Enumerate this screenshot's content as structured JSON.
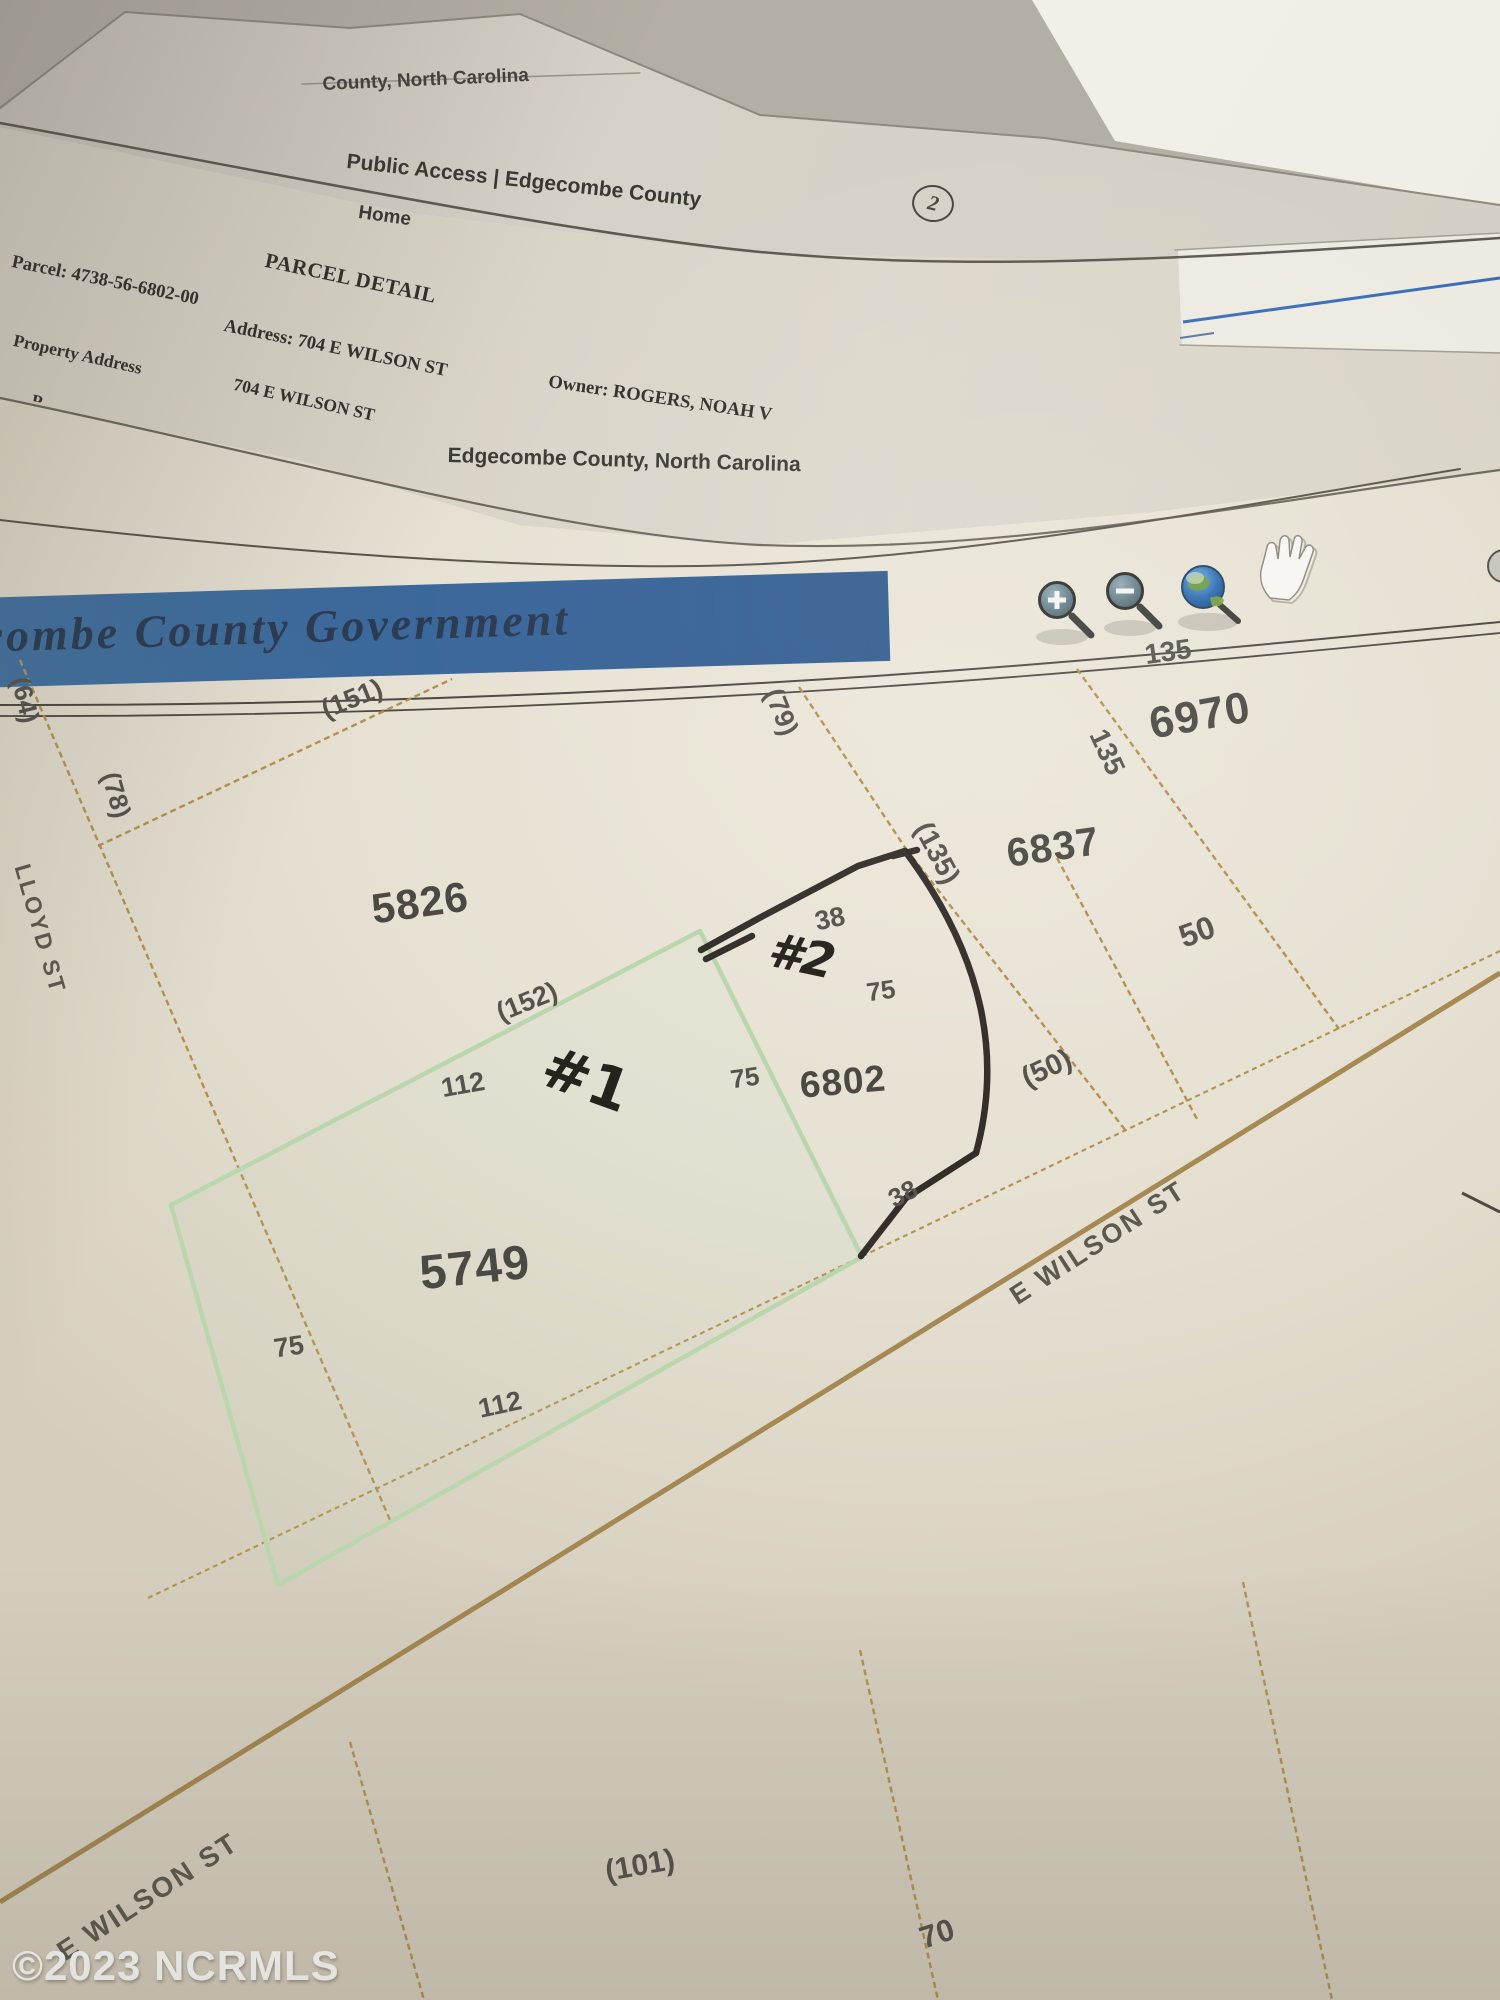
{
  "pages": {
    "top_sheet": {
      "header_fragment": "County, North Carolina",
      "site_title": "Public Access | Edgecombe County",
      "page_number": "2"
    },
    "detail_sheet": {
      "nav_home": "Home",
      "title": "PARCEL DETAIL",
      "parcel": "Parcel: 4738-56-6802-00",
      "address": "Address: 704 E WILSON ST",
      "owner": "Owner: ROGERS, NOAH V",
      "property_address_label": "Property Address",
      "property_address_value": "704 E WILSON ST",
      "clipped_row_fragment": "P"
    },
    "map_sheet": {
      "title": "Edgecombe County, North Carolina",
      "banner_text": "ecombe County Government",
      "toolbar_icons": [
        "zoom-in",
        "zoom-out",
        "globe",
        "pan-hand"
      ]
    }
  },
  "map": {
    "parcel_numbers": [
      {
        "text": "5826",
        "x": 420,
        "y": 903,
        "rot": -8,
        "fs": 42
      },
      {
        "text": "6970",
        "x": 1200,
        "y": 716,
        "rot": -10,
        "fs": 44
      },
      {
        "text": "6837",
        "x": 1053,
        "y": 848,
        "rot": -8,
        "fs": 40
      },
      {
        "text": "6802",
        "x": 843,
        "y": 1082,
        "rot": -5,
        "fs": 37
      },
      {
        "text": "5749",
        "x": 475,
        "y": 1268,
        "rot": -6,
        "fs": 48
      }
    ],
    "dimension_labels": [
      {
        "text": "(64)",
        "x": 25,
        "y": 700,
        "rot": 76,
        "fs": 26
      },
      {
        "text": "(151)",
        "x": 352,
        "y": 699,
        "rot": -22,
        "fs": 27
      },
      {
        "text": "(78)",
        "x": 116,
        "y": 795,
        "rot": 74,
        "fs": 26
      },
      {
        "text": "(79)",
        "x": 781,
        "y": 712,
        "rot": 68,
        "fs": 27
      },
      {
        "text": "135",
        "x": 1168,
        "y": 652,
        "rot": -8,
        "fs": 28
      },
      {
        "text": "135",
        "x": 1107,
        "y": 752,
        "rot": 65,
        "fs": 28
      },
      {
        "text": "(135)",
        "x": 937,
        "y": 853,
        "rot": 62,
        "fs": 28
      },
      {
        "text": "38",
        "x": 830,
        "y": 919,
        "rot": -12,
        "fs": 27
      },
      {
        "text": "75",
        "x": 881,
        "y": 991,
        "rot": -8,
        "fs": 26
      },
      {
        "text": "(152)",
        "x": 527,
        "y": 1002,
        "rot": -22,
        "fs": 27
      },
      {
        "text": "112",
        "x": 463,
        "y": 1085,
        "rot": -10,
        "fs": 27
      },
      {
        "text": "75",
        "x": 745,
        "y": 1078,
        "rot": -8,
        "fs": 26
      },
      {
        "text": "(50)",
        "x": 1047,
        "y": 1069,
        "rot": -25,
        "fs": 29
      },
      {
        "text": "50",
        "x": 1197,
        "y": 932,
        "rot": -20,
        "fs": 32
      },
      {
        "text": "38",
        "x": 903,
        "y": 1194,
        "rot": -28,
        "fs": 26
      },
      {
        "text": "75",
        "x": 289,
        "y": 1347,
        "rot": -8,
        "fs": 27
      },
      {
        "text": "112",
        "x": 500,
        "y": 1405,
        "rot": -12,
        "fs": 27
      },
      {
        "text": "(101)",
        "x": 640,
        "y": 1866,
        "rot": -10,
        "fs": 30
      },
      {
        "text": "70",
        "x": 937,
        "y": 1934,
        "rot": -18,
        "fs": 31
      }
    ],
    "street_labels": [
      {
        "text": "E WILSON ST",
        "x": 1098,
        "y": 1243,
        "rot": -33,
        "fs": 27
      },
      {
        "text": "LLOYD ST",
        "x": 40,
        "y": 929,
        "rot": 74,
        "fs": 23
      },
      {
        "text": "E WILSON ST",
        "x": 148,
        "y": 1897,
        "rot": -33,
        "fs": 28
      }
    ],
    "handwritten": {
      "lot1": "#1",
      "lot2": "#2"
    }
  },
  "watermark": {
    "text": "©2023 NCRMLS"
  },
  "colors": {
    "banner_blue": "#3f6da4",
    "parcel_line_tan": "#b3914e",
    "highlight_green": "#b9d6ac",
    "pen_black": "#292521",
    "road_brown": "#9a7a3e",
    "blue_rule": "#3a6db8"
  }
}
